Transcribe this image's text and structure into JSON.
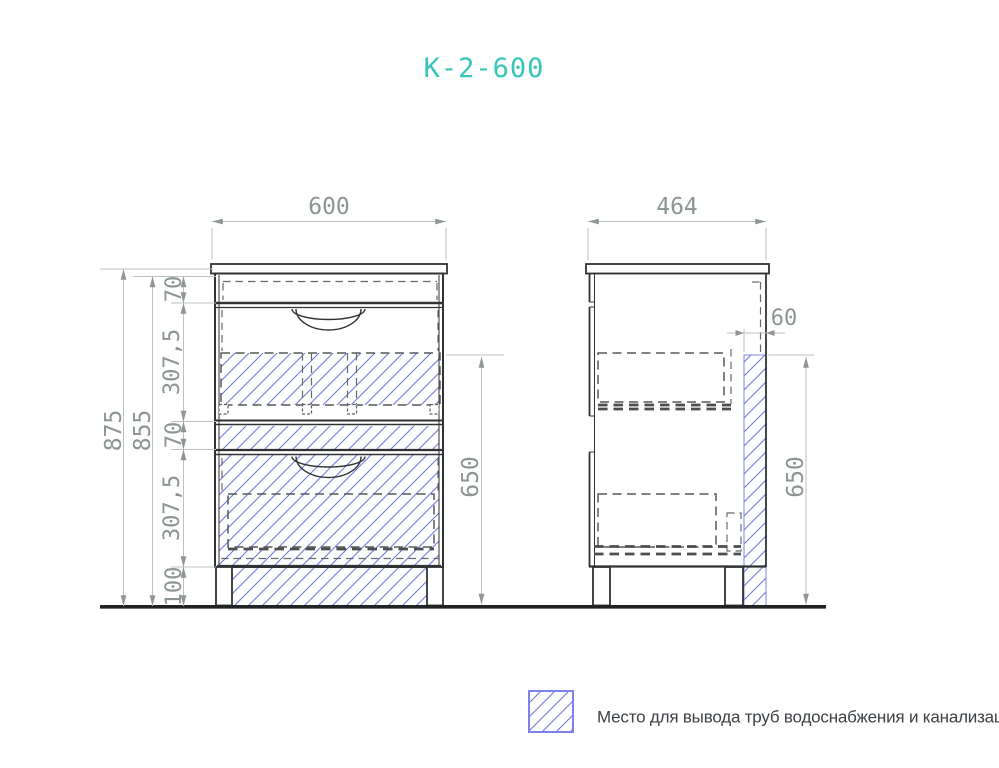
{
  "title": "К-2-600",
  "views": {
    "front": {
      "name": "front-view",
      "width": "600",
      "total_height": "875",
      "body_height": "855",
      "top_rail_height": "70",
      "drawer1_height": "307,5",
      "gap_height": "70",
      "drawer2_height": "307,5",
      "leg_height": "100",
      "pipe_zone_height": "650"
    },
    "side": {
      "name": "side-view",
      "depth": "464",
      "pipe_zone_depth": "60",
      "pipe_zone_height": "650"
    }
  },
  "legend": {
    "label": "Место для вывода труб водоснабжения и канализации"
  },
  "colors": {
    "title_teal": "#36c6ba",
    "hatch_blue": "#7177e2",
    "outline_dark": "#303234",
    "dimension_gray": "#8b9591"
  }
}
